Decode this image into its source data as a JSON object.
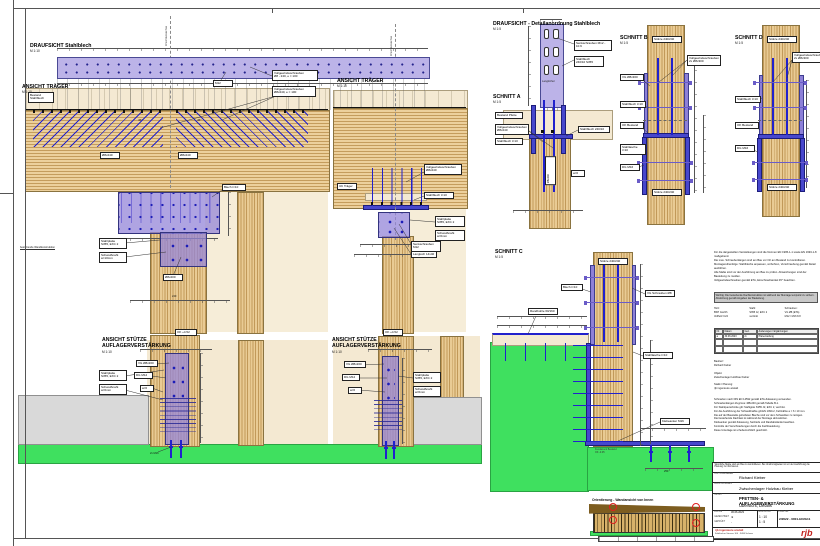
{
  "views": {
    "draufsicht": {
      "title": "DRAUFSICHT Stahlblech",
      "scale": "M 1:10",
      "axis": "Anschlussachse",
      "c1": "M12",
      "c2": "Vollgewindeschrauben\nØ8 - 240, e = 100"
    },
    "traeger_l": {
      "title": "ANSICHT TRÄGER",
      "scale": "M 1:10",
      "bestand": "Bestand\nStahlblech",
      "c_vg": "Vollgewindeschrauben\nØ8x240, e = 100",
      "c_blech": "Stahlblech",
      "ang_l": "45°",
      "ang_r": "45°",
      "tag_l": "Ø8x240",
      "tag_r": "Ø8x240",
      "plate_tag": "Blech t=10",
      "box1": "Stahlplatte\nS355, EXC 2",
      "box2": "Schweißnaht\na=10mm",
      "wand": "bestehende Wandkonstruktion",
      "c_dg": "Ø8x200",
      "dim": "240"
    },
    "stuetze_l": {
      "title": "ANSICHT STÜTZE\nAUFLAGERVERSTÄRKUNG",
      "scale": "M 1:10",
      "level": "OK +4.52",
      "c1": "VG Ø8x200",
      "c2": "DG M12",
      "c3": "a=6",
      "box1": "Stahlplatte\nS355, EXC 2",
      "box2": "Schweißnaht\na=6mm",
      "anchor": "2x M16"
    },
    "traeger_m": {
      "title": "ANSICHT TRÄGER",
      "scale": "M 1:10",
      "axis": "Anschlussachse",
      "level": "UK Träger",
      "c_vg": "Vollgewindeschrauben\nØ8x240",
      "c_blech": "Stahlblech t=10",
      "box1": "Stahlplatte\nS355, EXC 2",
      "box2": "Schweißnaht\na=6mm",
      "c_senk": "Senkschrauben M12",
      "c_lang": "Langloch 14x40"
    },
    "stuetze_m": {
      "title": "ANSICHT STÜTZE\nAUFLAGERVERSTÄRKUNG",
      "scale": "M 1:10",
      "level": "OK +4.52",
      "c1": "VG Ø8x200",
      "c2": "DG M12",
      "c3": "a=6",
      "box1": "Stahlplatte\nS355, EXC 2",
      "box2": "Schweißnaht\na=6mm"
    },
    "detail": {
      "title": "DRAUFSICHT - Detailanordnung Stahlblech",
      "scale": "M 1:5",
      "c_senk": "Senkschrauben M12 - 10.9",
      "c_blech": "Stahlblech\n240/10 S355",
      "inner": "Langlöcher"
    },
    "schnitt_a": {
      "title": "SCHNITT A",
      "scale": "M 1:5",
      "c1": "Bestand Pfette",
      "c2": "Vollgewindeschrauben\nØ8x240",
      "c3": "Stahlblech t=10",
      "c4": "Stahlblech 240/10",
      "inner": "Ø8x240",
      "c5": "a=6"
    },
    "schnitt_b": {
      "title": "SCHNITT B",
      "scale": "M 1:5",
      "top": "Stütze 240/240",
      "bottom": "Stütze 240/240",
      "c_tr": "Vollgewindeschrauben\n2x Ø8x300",
      "c1": "VG Ø8x300",
      "c2": "Stahlblech t=10",
      "c3": "OK Bestand",
      "c4": "Stahllasche t=10",
      "c5": "DG M16"
    },
    "schnitt_d": {
      "title": "SCHNITT D",
      "scale": "M 1:5",
      "top": "Stütze 240/240",
      "bottom": "Stütze 240/240",
      "c_tr": "Vollgewindeschrauben\n2x Ø8x300",
      "c1": "Stahlblech t=10",
      "c2": "OK Bestand",
      "c3": "DG M16"
    },
    "schnitt_c": {
      "title": "SCHNITT C",
      "scale": "M 1:5",
      "top": "Stütze 240/240",
      "c_rand": "Randbohle 60/160",
      "c_vg": "VG Schrauben Ø8",
      "c_blech": "Blech t=10",
      "c_lasche": "Stahllasche t=10",
      "c_anker": "Klebeanker M16",
      "fund": "Fundament Bestand\nOK -0.05",
      "dim": "250"
    }
  },
  "orientation": {
    "title": "Orientierung - Wandansicht von Innen"
  },
  "notes": {
    "top": "Für die dargestellten Verstärkungen sind die Normen EN 1995-1-1 sowie EN 1993-1-8 maßgebend.\nDie max. Schraubenlängen sind am Bau vor Ort am Bestand zu kontrollieren.\nMontagereihenfolge: Stahlbleche anpassen, vorbohren, Verschraubung gemäß Detail ausführen.\nAlle Maße sind vor der Ausführung am Bau zu prüfen. Abweichungen sind der Bauleitung zu melden.\nVollgewindeschrauben gemäß ETA, Einschraubwinkel 45° beachten.",
    "highlight": "Wichtig: Die bestehende Dachkonstruktion ist während der Montage temporär zu sichern.\nAbstützung gemäß Angaben der Bauleitung.",
    "col1": "Holz:\nBSH GL24h\nVollholz C24",
    "col2": "Stahl:\nS355 J2, EXC 2\nverzinkt",
    "col3": "Schrauben:\nVG Ø8 (ETA)\nM12 / M16 8.8",
    "rev_headers": [
      "Nr.",
      "Datum",
      "Gez.",
      "Änderungen / Ergänzungen"
    ],
    "rev_row": [
      "a",
      "30.06.2023",
      "rk",
      "Planerstellung"
    ],
    "mid": "Bauherr:\nRichard Kieber\n\nObjekt:\nZwischenlager Holzbau Kieber\n\nStatik / Planung:\nrjb ingenieure anstalt",
    "bottom": "Schrauben nach DIN EN 14592 gemäß ETA-Zulassung verwenden.\nSchraubenlängen Zugzone: Ø8x240 gemäß Tabelle B-1.\nFür Stahlquerschnitte gilt: Stahlgüte S355 J2, EXC 2, verzinkt.\nFür die Ausführung der Schweißnähte gilt EN 1090-2, Kehlnähte a = 6 / 10 mm.\nDie auf der Baustelle gehefteten Bleche sind vor dem Schweißen zu reinigen.\nDie bestehende Dachlast ist während der Montage abzustützen.\nKlebeanker gemäß Zulassung, Setztiefe und Randabstände beachten.\nKontrolle der Verschraubungen durch die Fachbauleitung.\nDiese Unterlage ist urheberrechtlich geschützt."
  },
  "title_block": {
    "disclaimer": "Sämtliche Maße sind am Bau zu kontrollieren. Bei Unstimmigkeiten ist vor der Ausführung die Planung zu informieren.",
    "l_auftraggeber": "AUFTRAGGEBER",
    "v_auftraggeber": "Richard Kieber",
    "l_bauvorhaben": "BAUVORHABEN",
    "v_bauvorhaben": "Zwischenlager Holzbau Kieber",
    "l_inhalt": "INHALT",
    "v_inhalt1": "PFETTEN- & AUFLAGERVERSTÄRKUNG",
    "v_inhalt2": "Übersicht, Details",
    "l_datum": "DATUM",
    "v_datum": "30.06.2023",
    "l_gez": "GEZEICHNET",
    "v_gez": "rk",
    "l_gep": "GEPRÜFT",
    "v_gep": "-",
    "l_mass": "MASSSTAB",
    "v_mass1": "1 : 10",
    "v_mass2": "1 : 5",
    "l_plan": "PLAN-NR.",
    "v_plan": "2/2622 - 0001-HO/G11",
    "company": "rjb ingenieure anstalt",
    "company2": "Feldkircher Strasse 100 · 9494 Schaan",
    "logo": "rjb"
  },
  "colors": {
    "screw_blue": "#2121cd",
    "plate_purple": "#8d80d8",
    "steel_lavender": "#bcb3e8",
    "ground_green": "#3fe05f",
    "timber": "#ecd09c",
    "logo_red": "#c2231f"
  }
}
